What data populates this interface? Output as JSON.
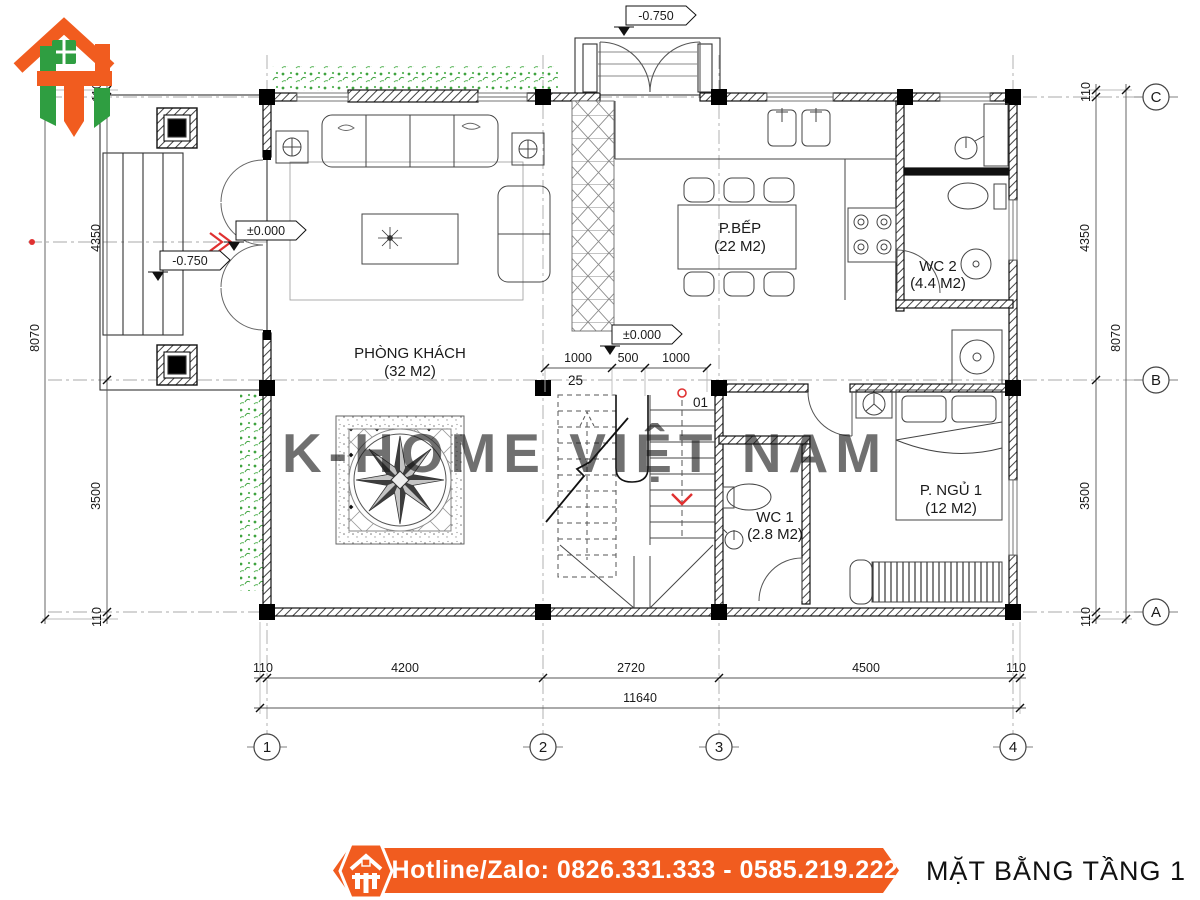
{
  "colors": {
    "accent_orange": "#f15c1f",
    "accent_green": "#2f9e41",
    "marker_red": "#e03131",
    "watermark_gray": "#cccccc"
  },
  "plan": {
    "watermark": "K-HOME VIỆT NAM",
    "rooms": {
      "living": {
        "name": "PHÒNG KHÁCH",
        "area": "(32 M2)"
      },
      "kitchen": {
        "name": "P.BẾP",
        "area": "(22 M2)"
      },
      "wc2": {
        "name": "WC 2",
        "area": "(4.4 M2)"
      },
      "wc1": {
        "name": "WC 1",
        "area": "(2.8 M2)"
      },
      "bedroom1": {
        "name": "P. NGỦ 1",
        "area": "(12 M2)"
      }
    },
    "elevations": {
      "entry_top": "-0.750",
      "porch_left": "-0.750",
      "porch_zero": "±0.000",
      "stair_zero": "±0.000"
    },
    "stairs": {
      "upper_flight_label": "25",
      "lower_flight_label": "01"
    },
    "dimensions": {
      "bottom_segments": [
        "110",
        "4200",
        "2720",
        "4500",
        "110"
      ],
      "bottom_total": "11640",
      "left_segments": [
        "110",
        "4350",
        "3500",
        "110"
      ],
      "left_total": "8070",
      "right_segments": [
        "110",
        "4350",
        "3500",
        "110"
      ],
      "right_total": "8070",
      "stair_segments": [
        "1000",
        "500",
        "1000"
      ]
    },
    "grid": {
      "columns": [
        "1",
        "2",
        "3",
        "4"
      ],
      "rows_top_to_bottom": [
        "C",
        "B",
        "A"
      ]
    }
  },
  "footer": {
    "hotline": "Hotline/Zalo: 0826.331.333 - 0585.219.222",
    "drawing_title": "MẶT BẰNG TẦNG 1"
  }
}
